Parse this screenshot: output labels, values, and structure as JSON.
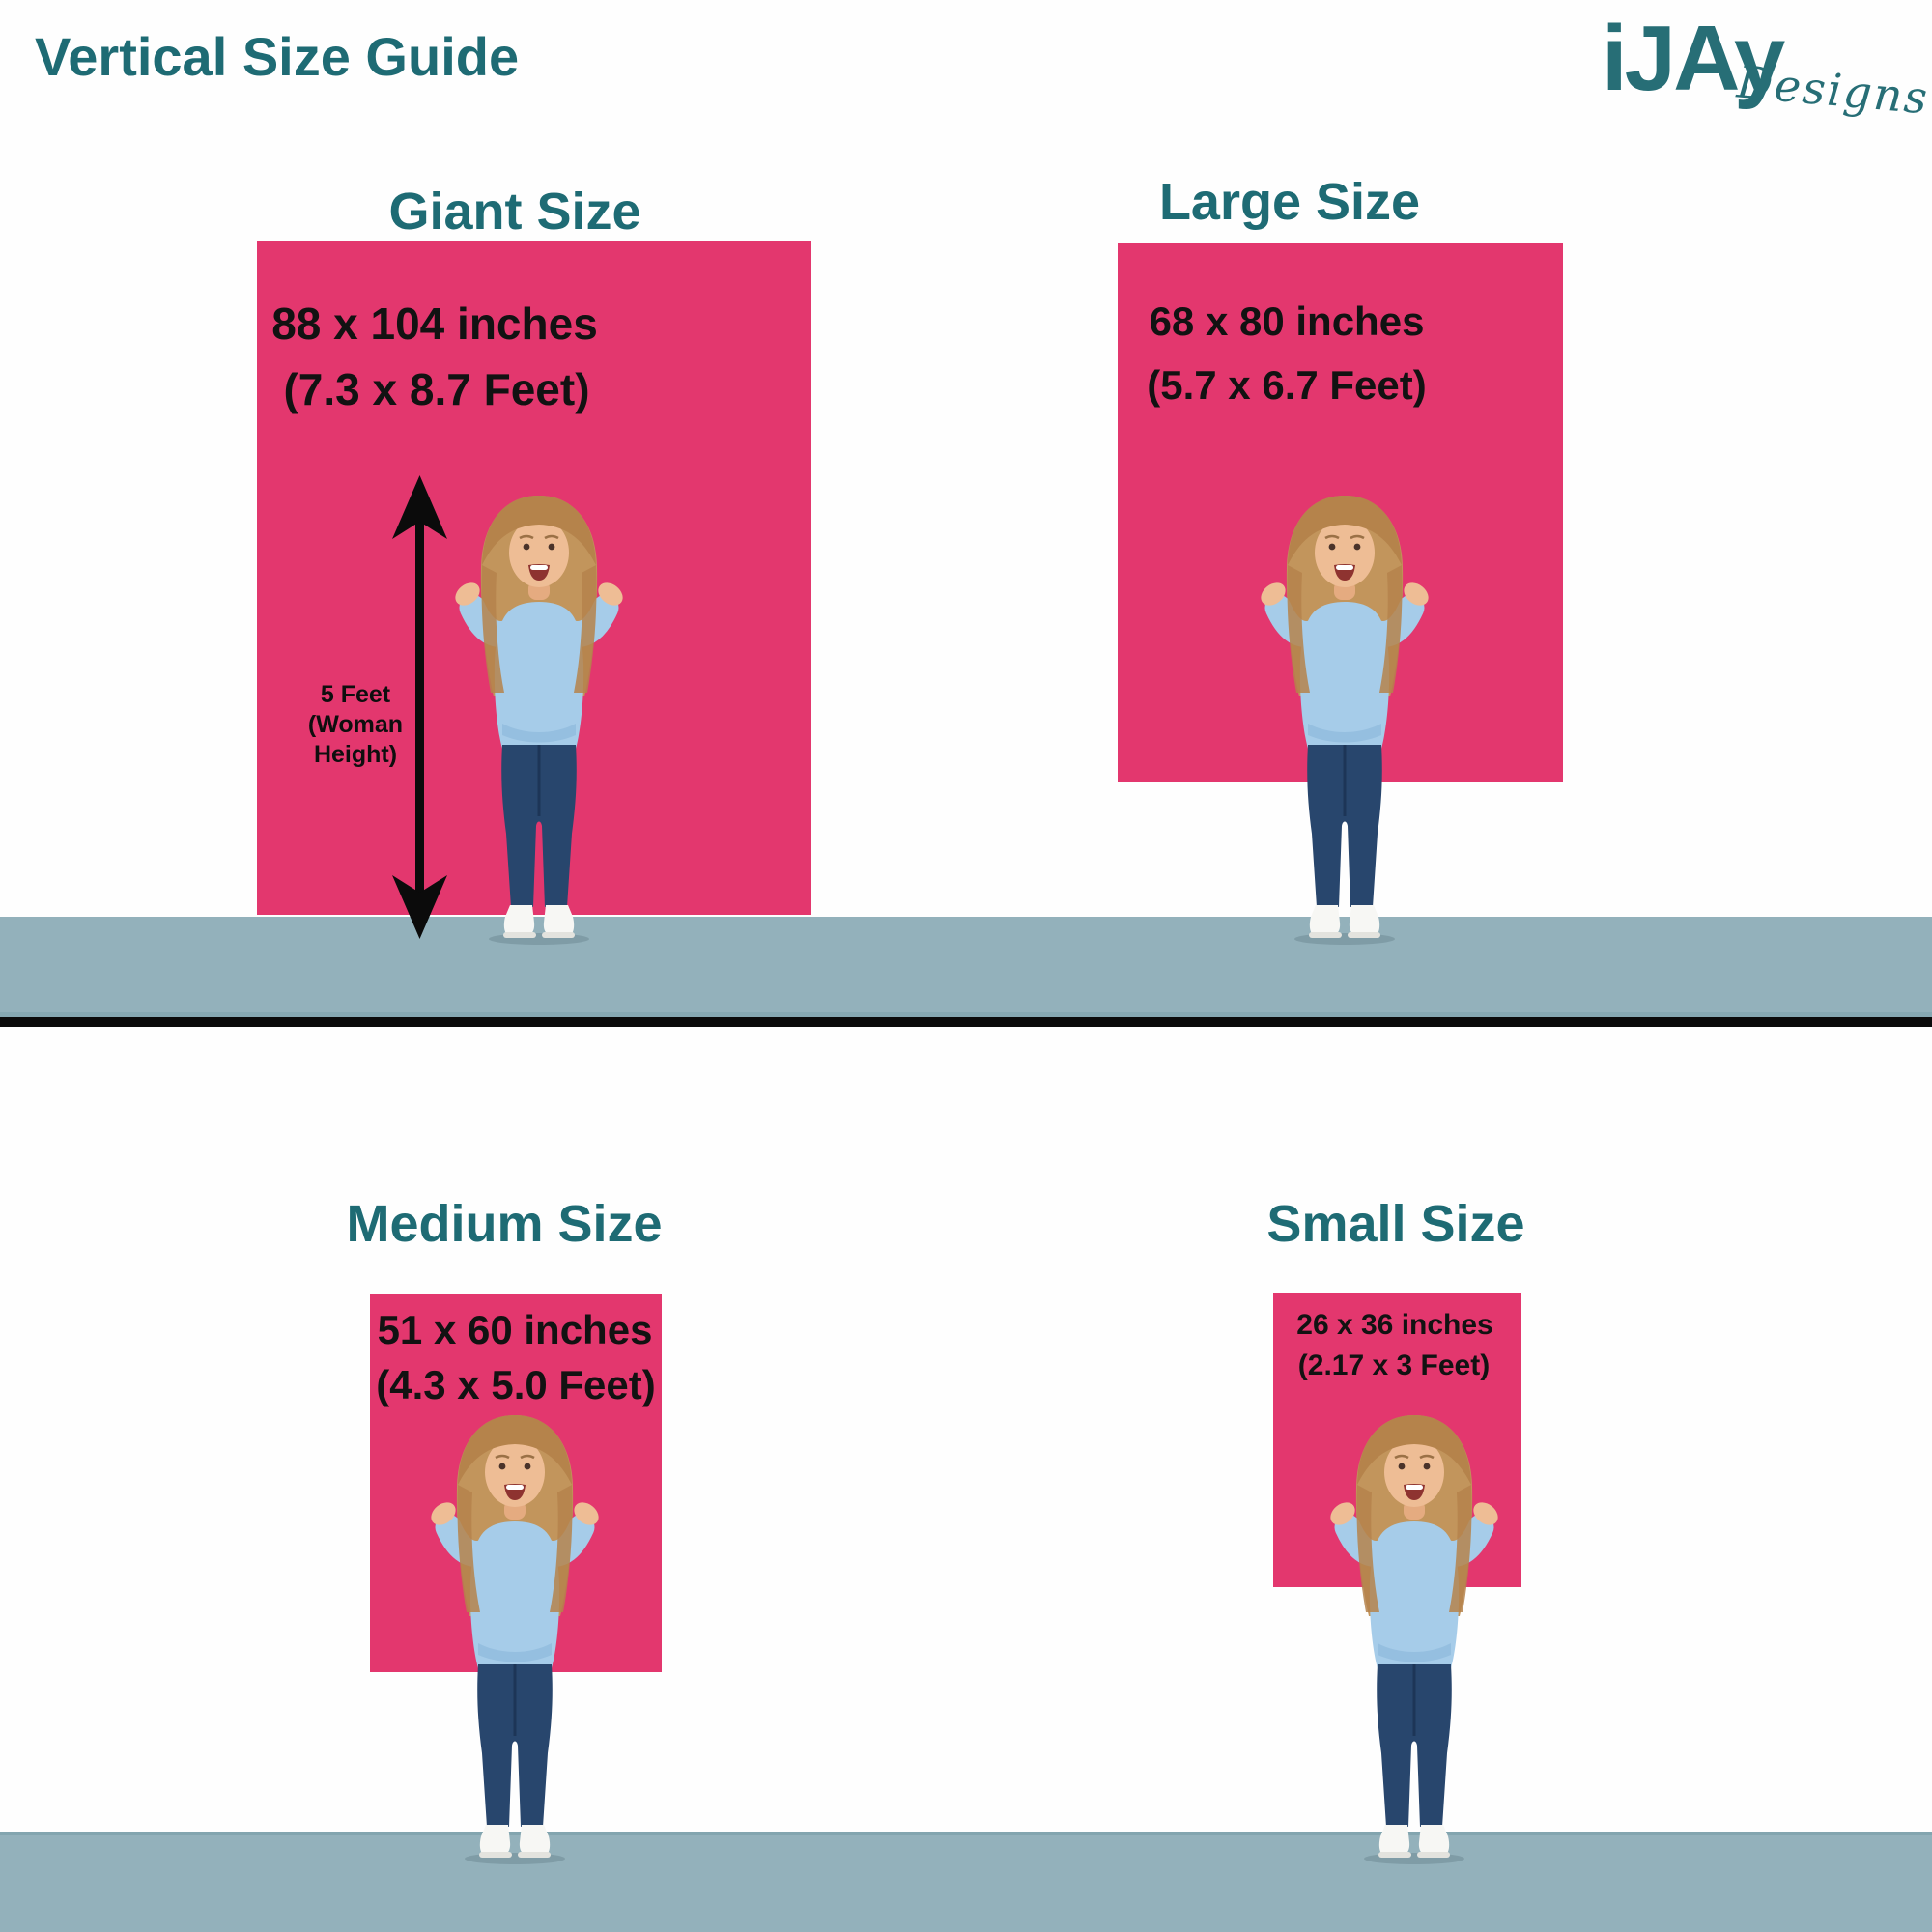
{
  "title": "Vertical Size Guide",
  "logo": {
    "brand": "iJAy",
    "sub": "Designs"
  },
  "panels": [
    {
      "name": "Giant",
      "heading": "Giant Size",
      "inches": "88 x 104 inches",
      "feet": "(7.3 x 8.7 Feet)"
    },
    {
      "name": "Large",
      "heading": "Large Size",
      "inches": "68 x 80 inches",
      "feet": "(5.7 x 6.7 Feet)"
    },
    {
      "name": "Medium",
      "heading": "Medium Size",
      "inches": "51 x 60 inches",
      "feet": "(4.3 x 5.0 Feet)"
    },
    {
      "name": "Small",
      "heading": "Small Size",
      "inches": "26 x 36 inches",
      "feet": "(2.17 x 3 Feet)"
    }
  ],
  "height_marker": {
    "line1": "5 Feet",
    "line2": "(Woman",
    "line3": "Height)"
  },
  "colors": {
    "teal": "#1e6b74",
    "pink": "#e3376e",
    "floor_band": "#93b1bb",
    "divider": "#0b0b0b",
    "text_black": "#121212"
  }
}
